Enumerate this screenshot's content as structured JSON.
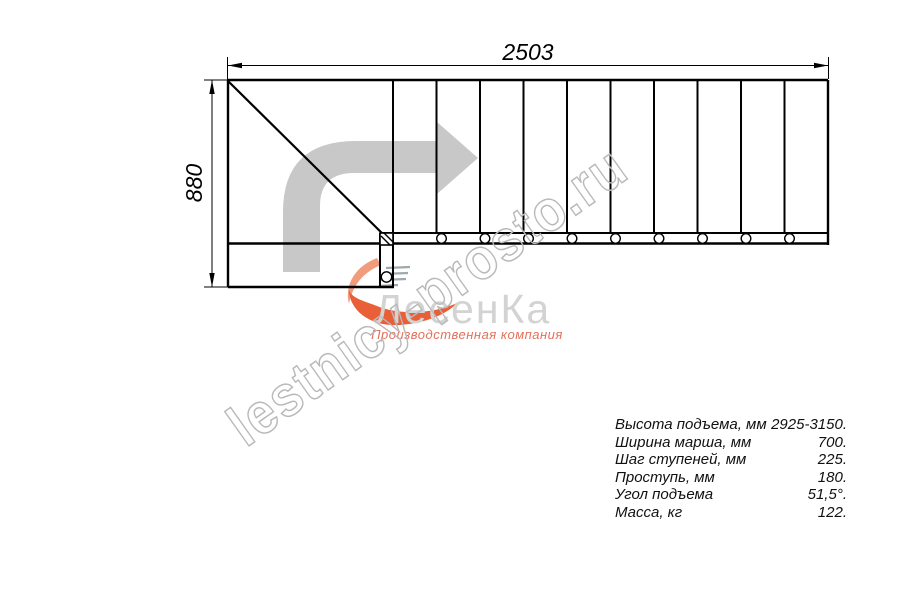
{
  "drawing": {
    "dim_top": "2503",
    "dim_left": "880",
    "watermark": "lestnicy-prosto.ru"
  },
  "logo": {
    "name": "ЛесенКа",
    "tagline": "Производственная компания"
  },
  "specs": {
    "rows": [
      {
        "label": "Высота подъема, мм",
        "value": "2925-3150."
      },
      {
        "label": "Ширина марша, мм",
        "value": "700."
      },
      {
        "label": "Шаг ступеней, мм",
        "value": "225."
      },
      {
        "label": "Проступь, мм",
        "value": "180."
      },
      {
        "label": "Угол подъема",
        "value": "51,5°."
      },
      {
        "label": "Масса, кг",
        "value": "122."
      }
    ]
  },
  "colors": {
    "line": "#000000",
    "arrow_gray": "#c8c8c8",
    "watermark_gray": "#b9b9b9",
    "logo_gray": "#d3d3d3",
    "logo_orange_light": "#f29c7e",
    "logo_orange_dark": "#e85f38",
    "logo_tagline_red": "#e4705a"
  }
}
